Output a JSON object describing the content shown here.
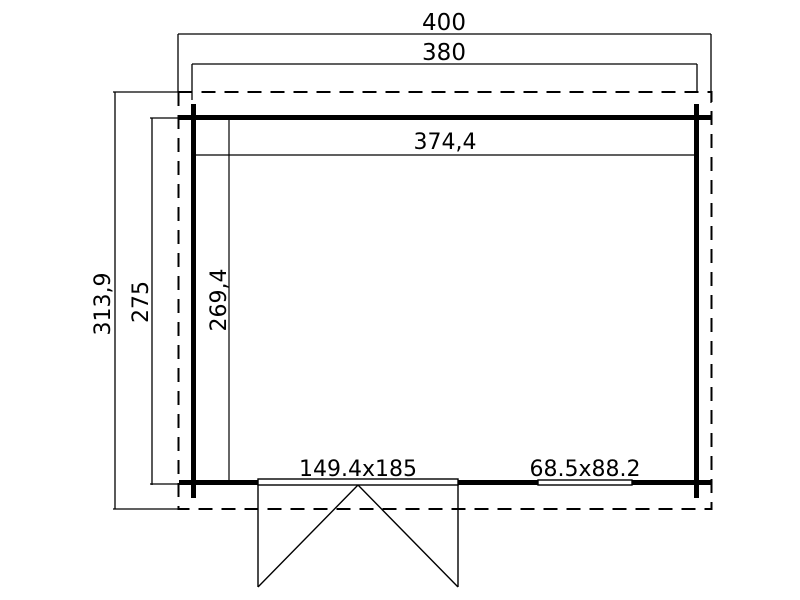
{
  "plan": {
    "dimensions": {
      "overall_width": "400",
      "wall_width": "380",
      "interior_width": "374,4",
      "overall_depth": "313,9",
      "wall_depth": "275",
      "interior_depth": "269,4"
    },
    "openings": {
      "door_size": "149.4x185",
      "window_size": "68.5x88.2"
    },
    "colors": {
      "line": "#000000",
      "background": "#ffffff"
    }
  }
}
